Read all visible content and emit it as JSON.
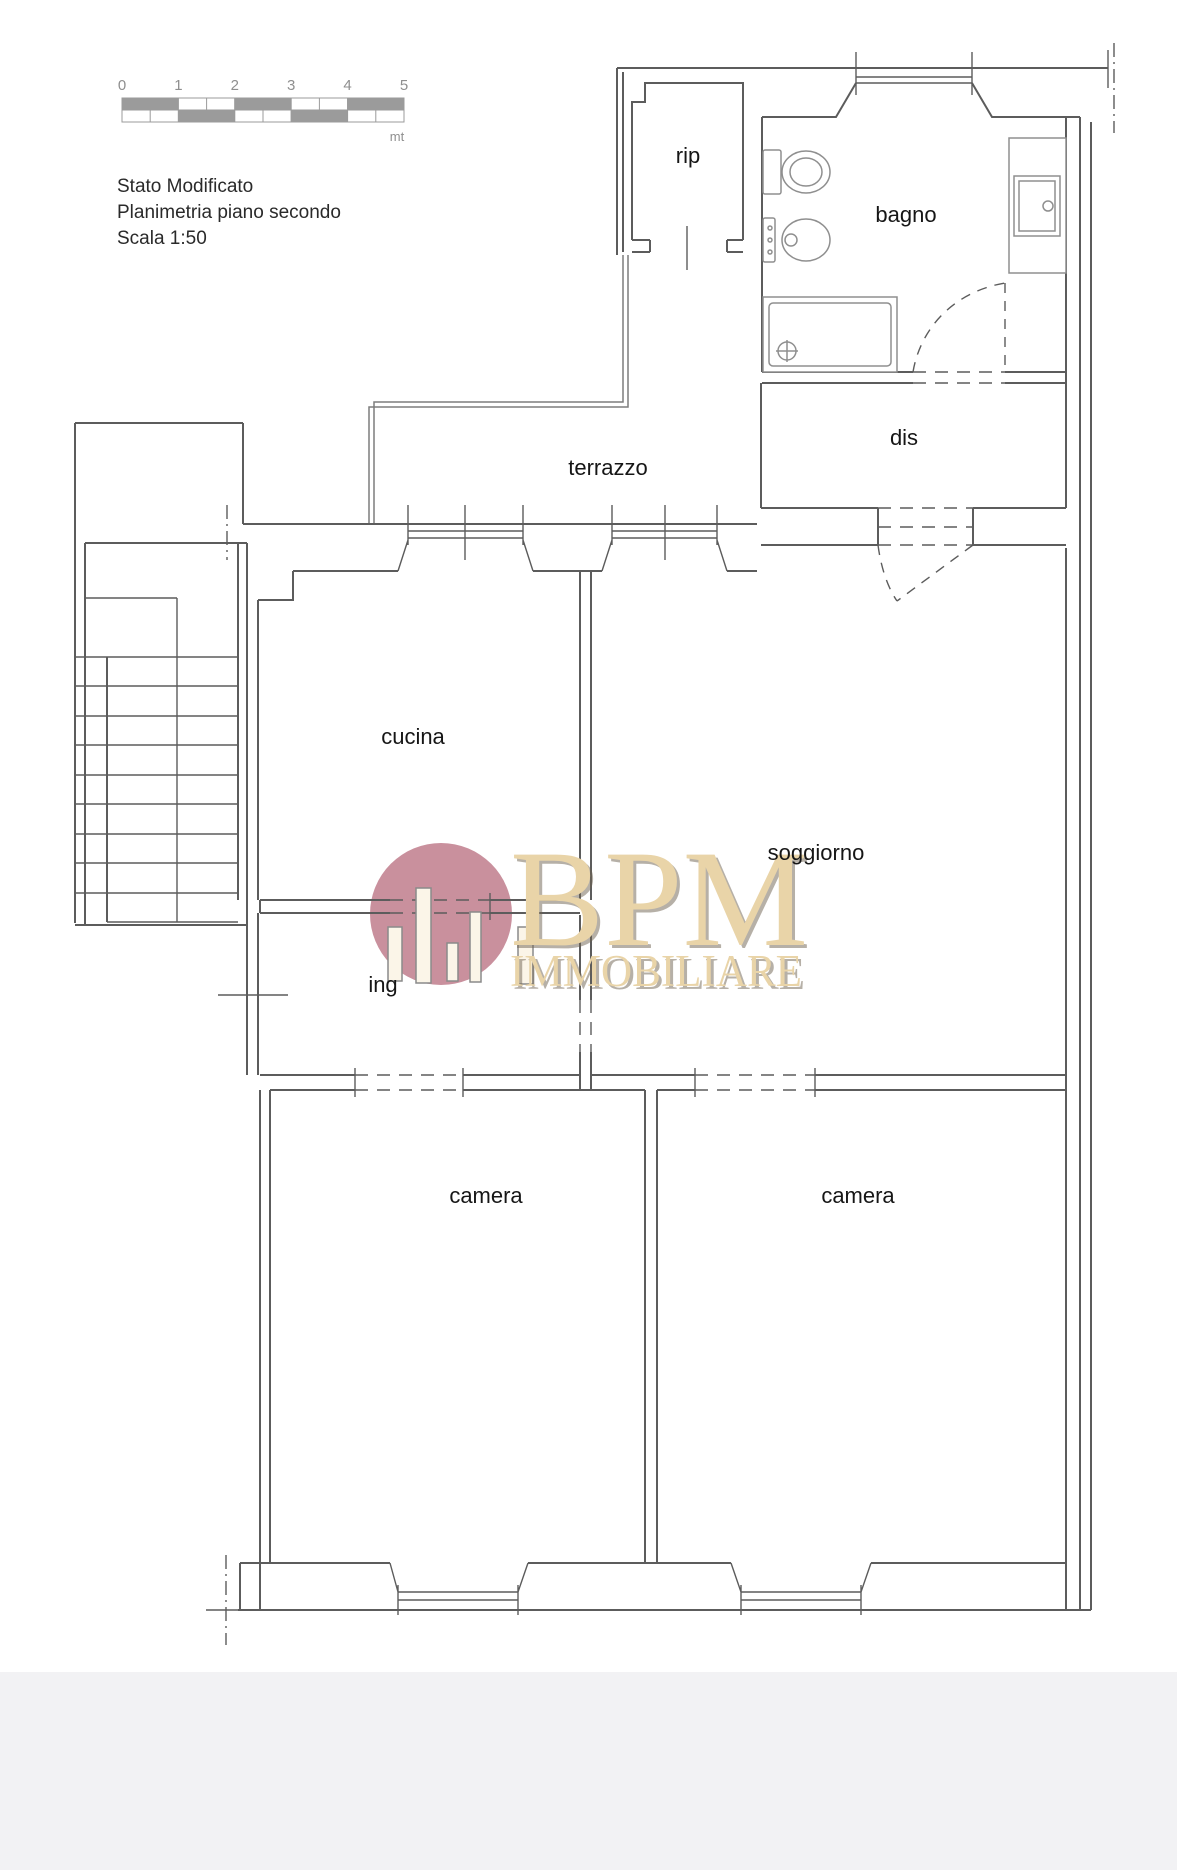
{
  "title": {
    "line1": "Stato Modificato",
    "line2": "Planimetria piano secondo",
    "line3": "Scala 1:50"
  },
  "scalebar": {
    "ticks": [
      "0",
      "1",
      "2",
      "3",
      "4",
      "5"
    ],
    "unit": "mt"
  },
  "rooms": [
    {
      "label": "rip"
    },
    {
      "label": "bagno"
    },
    {
      "label": "dis"
    },
    {
      "label": "terrazzo"
    },
    {
      "label": "cucina"
    },
    {
      "label": "soggiorno"
    },
    {
      "label": "ing"
    },
    {
      "label": "camera"
    },
    {
      "label": "camera"
    }
  ],
  "logo": {
    "name": "BPM",
    "subtitle": "IMMOBILIARE"
  },
  "colors": {
    "wall": "#5c5c5c",
    "fixture": "#8f8f8f",
    "scalebar_fill": "#9b9b9b",
    "logo_circle": "#c9909d",
    "logo_text": "#e9d4a8",
    "bottom_strip": "#f2f2f4"
  }
}
